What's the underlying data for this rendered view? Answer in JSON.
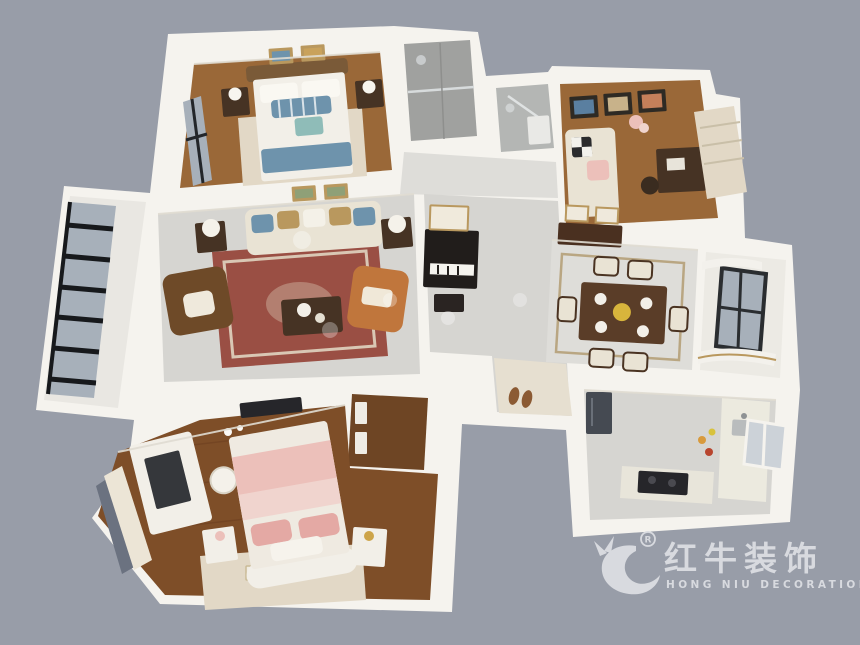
{
  "scene": {
    "type": "isometric-3d-floorplan-render",
    "rooms": [
      "master-bedroom",
      "shower-bathroom",
      "guest-bathroom",
      "study-room",
      "living-room",
      "balcony",
      "hallway",
      "dining-room",
      "bay-window-room",
      "kitchen",
      "entry-nook",
      "walk-in-closet",
      "secondary-bedroom"
    ]
  },
  "watermark": {
    "brand_cn": "红牛装饰",
    "brand_en": "HONG NIU DECORATION",
    "registered_mark": "R",
    "color": "#D8DADF"
  },
  "colors": {
    "background": "#989DA8",
    "wall": "#F5F3EE",
    "wall_shade": "#E3E0D8",
    "marble": "#D6D5D1",
    "marble_light": "#DEDDD9",
    "wood": "#9A6838",
    "wood_dark": "#6E4524",
    "wood_herringbone": "#7E4E28",
    "tile_gray": "#A0A19F",
    "tile_light": "#B4B6B4",
    "rug_red": "#9A4F44",
    "rug_cream": "#E2D8C6",
    "sofa_cream": "#E9E3D4",
    "white_furniture": "#F2EFE8",
    "accent_blue": "#6E93AC",
    "accent_teal": "#8FBCB8",
    "accent_pink": "#ECC0BA",
    "accent_pink_light": "#F0D4CE",
    "accent_orange": "#C0763C",
    "leather_brown": "#6E4A28",
    "furniture_dark": "#463324",
    "black_frame": "#1E2022",
    "glass": "#A7B0BA",
    "gold_trim": "#B9985E",
    "watermark_color": "#D8DADF"
  }
}
